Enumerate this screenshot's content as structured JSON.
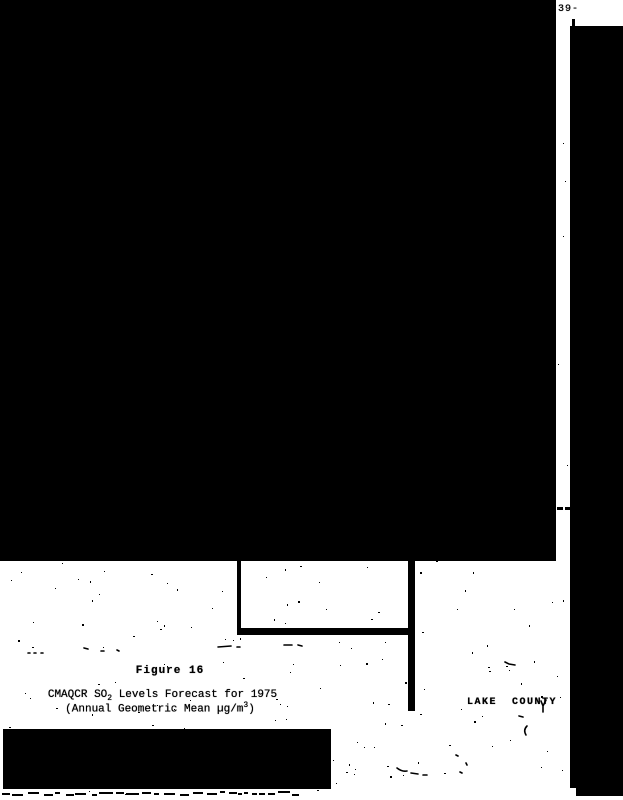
{
  "colors": {
    "ink": "#000000",
    "paper": "#ffffff"
  },
  "page": {
    "page_number": "-39-",
    "figure": {
      "label": "Figure 16",
      "caption_line1": {
        "prefix": "CMAQCR SO",
        "sub": "2",
        "suffix": " Levels Forecast for 1975"
      },
      "caption_line2": {
        "prefix": "(Annual Geometric Mean µg/m",
        "sup": "3",
        "suffix": ")"
      }
    },
    "map_labels": {
      "lake_county": "LAKE  COUNTY"
    }
  }
}
